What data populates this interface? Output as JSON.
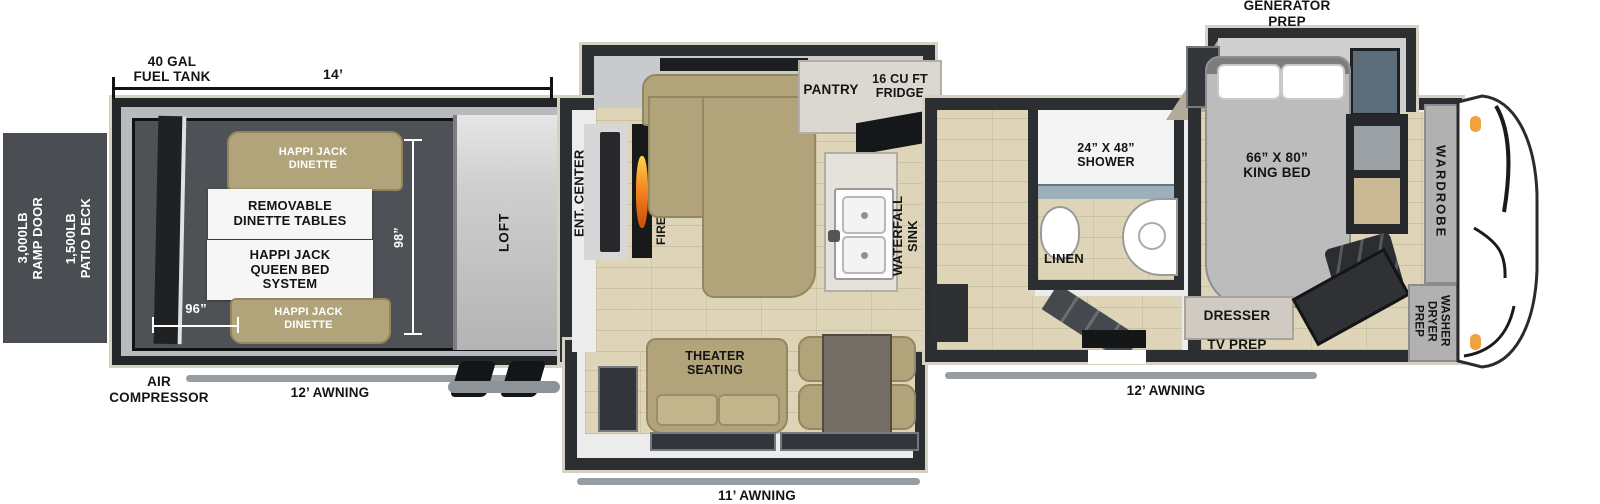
{
  "exterior": {
    "ramp_door": "3,000LB\nRAMP DOOR",
    "patio_deck": "1,500LB\nPATIO DECK",
    "fuel_tank": "40 GAL\nFUEL TANK",
    "garage_length": "14’",
    "air_compressor": "AIR\nCOMPRESSOR",
    "awning_rear": "12’ AWNING",
    "awning_center": "11’ AWNING",
    "awning_front": "12’ AWNING",
    "generator_prep": "GENERATOR\nPREP"
  },
  "garage": {
    "dinette_top": "HAPPI JACK\nDINETTE",
    "removable_tables": "REMOVABLE\nDINETTE TABLES",
    "queen_bed": "HAPPI JACK\nQUEEN BED\nSYSTEM",
    "dinette_bottom": "HAPPI JACK\nDINETTE",
    "loft": "LOFT",
    "width_dim": "98”",
    "bed_dim": "96”"
  },
  "living": {
    "ent_center": "ENT. CENTER",
    "fireplace": "FIREPLACE",
    "pantry": "PANTRY",
    "fridge": "16 CU FT\nFRIDGE",
    "waterfall_sink": "WATERFALL\nSINK",
    "overhead_cabinets": "OHC MICRO OHC",
    "theater_seating": "THEATER\nSEATING"
  },
  "bathroom": {
    "shower": "24” X 48”\nSHOWER",
    "linen": "LINEN"
  },
  "bedroom": {
    "king_bed": "66” X 80”\nKING BED",
    "dresser": "DRESSER",
    "tv_prep": "TV PREP",
    "wardrobe": "WARDROBE",
    "washer_dryer_prep": "WASHER\nDRYER\nPREP"
  },
  "colors": {
    "wall": "#2c2f32",
    "trim": "#d7d1c3",
    "wood_floor": "#ded5b8",
    "furniture_tan": "#b2a47a",
    "awning_gray": "#989da1",
    "flame_orange": "#f6881f",
    "clearance_light_orange": "#f0a23f"
  }
}
